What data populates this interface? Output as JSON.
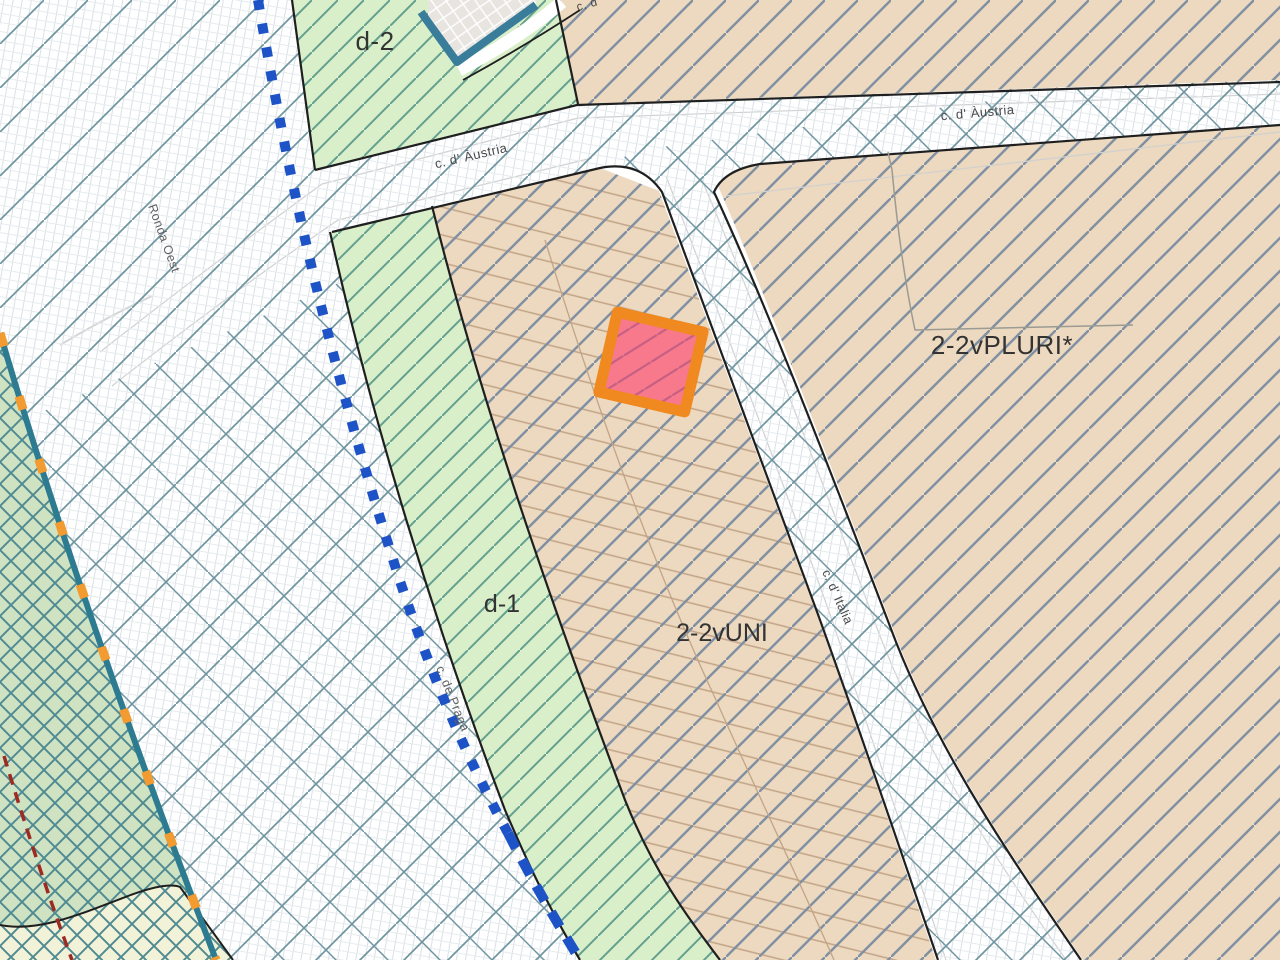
{
  "map": {
    "labels": {
      "zone_d2": "d-2",
      "zone_d1": "d-1",
      "zone_uni": "2-2vUNI",
      "zone_pluri": "2-2vPLURI*",
      "street_austria_left": "c. d' Àustria",
      "street_austria_right": "c. d' Àustria",
      "street_italia": "c. d' Itàlia",
      "street_ronda_oest": "Ronda Oest",
      "street_praga": "c. de Praga",
      "street_top_partial": "c. d"
    },
    "colors": {
      "white": "#ffffff",
      "tan": "#ecd9bf",
      "green": "#d9efca",
      "green_dark": "#cfe2c2",
      "yellow": "#f2f2d8",
      "building_gray": "#e8e5e1",
      "fine_grid": "#d9e1e7",
      "fine_grid2": "#e6ebef",
      "hatch_teal": "#6f95a0",
      "hatch_blue": "#8090a2",
      "hatch_green": "#63a08f",
      "hatch_cross": "#4f8a92",
      "parcel_line": "#c2a487",
      "inner_line": "#9b9b94",
      "street_line": "#d0d0d0",
      "black": "#1f1f1f",
      "building_teal": "#3a7d9b",
      "dotted_blue": "#1d53c6",
      "boundary_teal": "#2c7b90",
      "boundary_orange": "#f19b30",
      "boundary_red": "#9e2b22",
      "highlight_fill": "#f8798b",
      "highlight_hatch": "#c45f84",
      "highlight_border": "#f0891f",
      "label_dark": "#333333",
      "label_gray": "#4a4a4a"
    }
  }
}
